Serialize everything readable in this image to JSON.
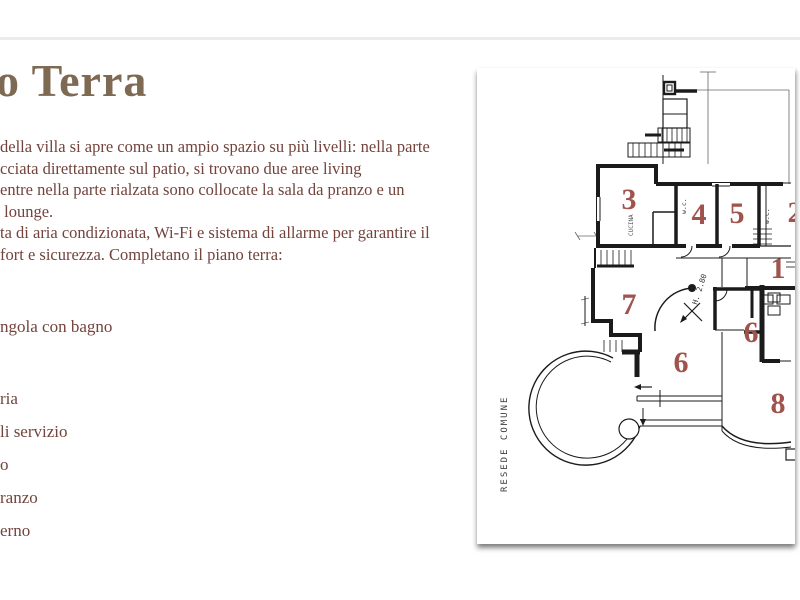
{
  "slide": {
    "background": "#ffffff"
  },
  "title": {
    "text": "o Terra",
    "color": "#7e6a52"
  },
  "paragraph": {
    "color": "#73433c",
    "lines": [
      "della villa si apre come un ampio spazio su più livelli: nella parte",
      "cciata direttamente sul patio, si trovano due aree living",
      "entre nella parte rialzata sono collocate la sala da pranzo e un",
      " lounge.",
      "ta di aria condizionata, Wi-Fi e sistema di allarme per garantire il",
      "fort e sicurezza. Completano il piano terra:"
    ]
  },
  "list": {
    "items": [
      "ngola con bagno",
      "ria",
      "li servizio",
      "o",
      "ranzo",
      "erno"
    ]
  },
  "floorplan": {
    "number_color": "#a0524c",
    "line_color": "#1b1b1b",
    "numbers": [
      "3",
      "4",
      "5",
      "2",
      "1",
      "7",
      "6",
      "6",
      "8"
    ],
    "annotations": {
      "site_label": "RESEDE COMUNE",
      "height_note": "H. 2.80",
      "wc_label": "w.c.",
      "kitchen_label": "CUCINA"
    }
  }
}
